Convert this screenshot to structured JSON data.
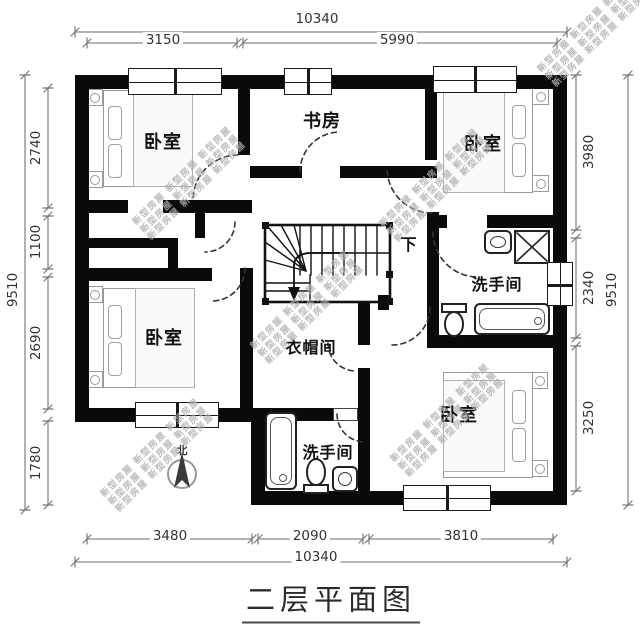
{
  "title": "二层平面图",
  "compass_label": "北",
  "watermark_line": "新型房屋 新型房屋 新型房屋",
  "rooms": {
    "bedroom_tl": "卧室",
    "study": "书房",
    "bedroom_tr": "卧室",
    "bath_right": "洗手间",
    "bedroom_bl": "卧室",
    "closet": "衣帽间",
    "bath_bottom": "洗手间",
    "bedroom_br": "卧室",
    "stairs_down": "下"
  },
  "dimensions": {
    "top_overall": "10340",
    "top_segments": [
      "3150",
      "5990"
    ],
    "bottom_segments": [
      "3480",
      "2090",
      "3810"
    ],
    "bottom_overall": "10340",
    "left_overall": "9510",
    "left_segments": [
      "2740",
      "1100",
      "2690",
      "1780"
    ],
    "right_segments": [
      "3980",
      "2340",
      "3250"
    ],
    "right_overall": "9510"
  },
  "colors": {
    "wall": "#0a0a0a",
    "dim_line": "#888888",
    "dim_text": "#333333",
    "furniture_stroke": "#999999",
    "watermark": "#b0b0b0"
  }
}
